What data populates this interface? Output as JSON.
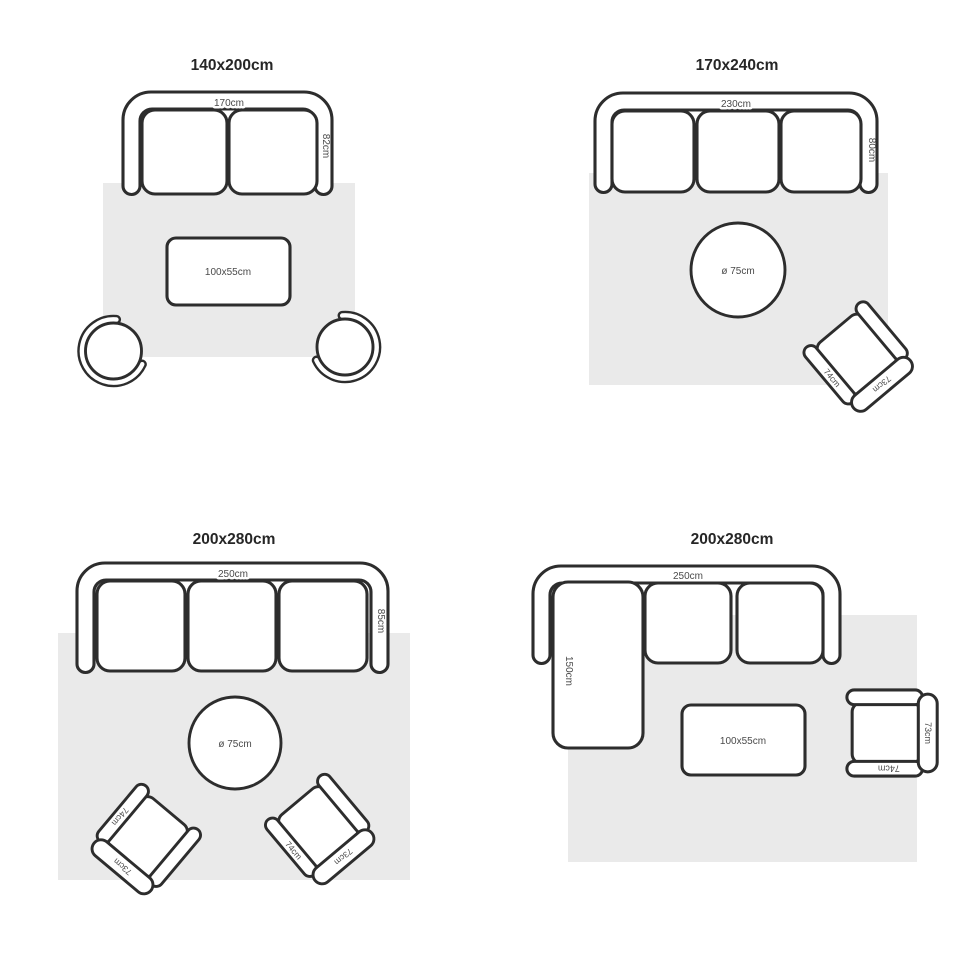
{
  "colors": {
    "background": "#ffffff",
    "rug": "#eaeaea",
    "outline": "#2d2d2d",
    "dimension_text": "#4a4a4a",
    "title_text": "#262626"
  },
  "quadrants": [
    {
      "title": "140x200cm",
      "sofa": {
        "type": "2-seat sofa",
        "width_label": "170cm",
        "depth_label": "82cm"
      },
      "table": {
        "shape": "rectangle",
        "label": "100x55cm"
      },
      "seats": [
        {
          "type": "round tub chair"
        },
        {
          "type": "round tub chair"
        }
      ]
    },
    {
      "title": "170x240cm",
      "sofa": {
        "type": "3-seat sofa",
        "width_label": "230cm",
        "depth_label": "80cm"
      },
      "table": {
        "shape": "round",
        "label": "ø 75cm"
      },
      "chair": {
        "arm_label": "74cm",
        "back_label": "73cm"
      }
    },
    {
      "title": "200x280cm",
      "sofa": {
        "type": "3-seat sofa",
        "width_label": "250cm",
        "depth_label": "85cm"
      },
      "table": {
        "shape": "round",
        "label": "ø 75cm"
      },
      "chair_left": {
        "arm_label": "74cm",
        "back_label": "73cm"
      },
      "chair_right": {
        "arm_label": "74cm",
        "back_label": "73cm"
      }
    },
    {
      "title": "200x280cm",
      "sofa": {
        "type": "corner sofa",
        "width_label": "250cm",
        "chaise_label": "150cm"
      },
      "table": {
        "shape": "rectangle",
        "label": "100x55cm"
      },
      "chair": {
        "arm_label": "74cm",
        "back_label": "73cm"
      }
    }
  ]
}
